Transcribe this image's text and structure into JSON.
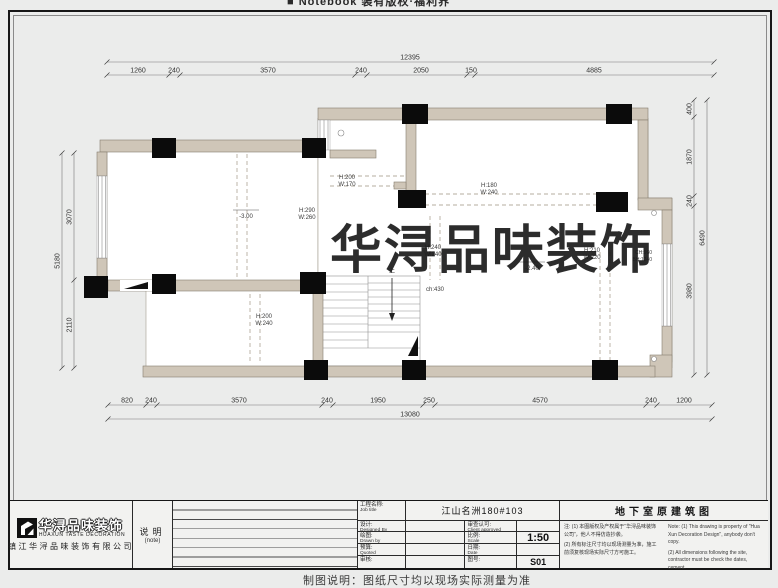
{
  "frame": {
    "top_note": "■ Notebook 装有版权·福利界",
    "bottom_note": "制图说明：图纸尺寸均以现场实际测量为准"
  },
  "watermark": "华浔品味装饰",
  "colors": {
    "wall": "#cfc6b8",
    "column": "#0b0b0b",
    "paper": "#ebeceb",
    "dim_line": "#777777",
    "dashed_beam": "#b5ad9f",
    "watermark_text": "#1a1a1a"
  },
  "dims": {
    "top": {
      "total": "12395",
      "segments": [
        "1260",
        "240",
        "3570",
        "240",
        "2050",
        "150",
        "4885"
      ]
    },
    "bottom": {
      "total": "13080",
      "segments": [
        "820",
        "240",
        "3570",
        "240",
        "1950",
        "250",
        "4570",
        "240",
        "1200"
      ]
    },
    "left": {
      "total": "5180",
      "segments": [
        "3070",
        "2110"
      ]
    },
    "right": {
      "total": "6490",
      "segments": [
        "400",
        "1870",
        "240",
        "3980"
      ]
    }
  },
  "ann": {
    "b1h": "H:200",
    "b1w": "W:170",
    "b2h": "H:290",
    "b2w": "W:260",
    "b3h": "H:180",
    "b3w": "W:240",
    "b4h": "H:200",
    "b4w": "W:240",
    "b5h": "H:210",
    "b5w": "W:220",
    "b6h": "H:240",
    "b6w": "W:240",
    "ch": "ch:430",
    "lvl1": "-3.00",
    "lvl2": "-2.40",
    "win1": "CH:960",
    "win2": "BH:1240",
    "stair": "上"
  },
  "tb": {
    "logo_text": "华浔品味装饰",
    "logo_en": "HUAXUN TASTE DECORATION",
    "company": "镇江华浔品味装饰有限公司",
    "note_label": "说明",
    "note_label_en": "(note)",
    "job_cn": "工程名称:",
    "job_en": "Job title",
    "job_value": "江山名洲180#103",
    "design_cn": "设计:",
    "design_en": "Designed By",
    "approve_cn": "审查认可:",
    "approve_en": "Client approved",
    "draw_cn": "绘图:",
    "draw_en": "Drawn by",
    "scale_cn": "比例:",
    "scale_en": "Scale",
    "scale_value": "1:50",
    "quote_cn": "预算:",
    "quote_en": "Quoted",
    "date_cn": "日期:",
    "date_en": "Date",
    "check_cn": "审核:",
    "sheet_cn": "图号:",
    "sheet_value": "S01",
    "drawing_title": "地下室原建筑图",
    "notes_cn1": "注: (1) 本图版权及产权属于“华浔品味装饰公司”，他人不得仿造抄袭。",
    "notes_cn2": "(2) 所有标注尺寸均以现场测量为准，施工前须复核现场实际尺寸方可施工。",
    "notes_en1": "Note: (1) This drawing is property of \"Hua Xun Decoration Design\", anybody don't copy.",
    "notes_en2": "(2) All dimensions following the site, contractor must be check the dates, cement."
  }
}
